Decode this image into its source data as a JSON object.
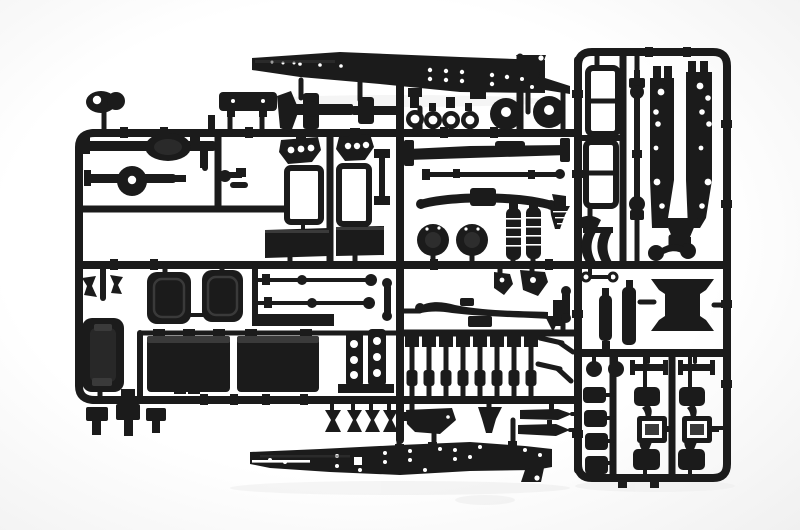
{
  "photo": {
    "subject": "injection-molded-plastic-model-kit-sprue",
    "content": "black truck chassis model parts attached to rectangular runner frame",
    "parts": [
      "chassis-rail-top",
      "chassis-rail-bottom",
      "frame-rail-left",
      "frame-rail-right",
      "rear-axle-1",
      "rear-axle-2",
      "front-axle-beam",
      "tie-rods",
      "leaf-spring-front",
      "leaf-spring-mid",
      "drive-shaft",
      "ladder-frames",
      "wheel-discs",
      "tow-rings",
      "brake-drums",
      "coil-springs",
      "cab-mount-brackets",
      "window-frames",
      "dash-panels",
      "seat-cushions",
      "door-panel-ring",
      "fuel-tank-1",
      "fuel-tank-2",
      "cross-plates",
      "push-rod-rack",
      "engine-lump",
      "exhaust-funnel",
      "spear-rods",
      "mounting-clips",
      "fifth-wheel-stand",
      "air-tanks",
      "dumbbell-link",
      "spool-pillars",
      "channel-rods",
      "pad-stack",
      "hub-bracket-assembly-1",
      "hub-bracket-assembly-2",
      "small-brackets"
    ]
  },
  "colors": {
    "background": "#ffffff",
    "vignette": "#f0f0f0",
    "plastic": "#1b1b1b",
    "plastic_dark": "#0d0d0d",
    "plastic_highlight": "#3a3a3a",
    "bracket_gray": "#4a4a4a",
    "hole": "#ffffff",
    "shadow": "#ececec"
  }
}
